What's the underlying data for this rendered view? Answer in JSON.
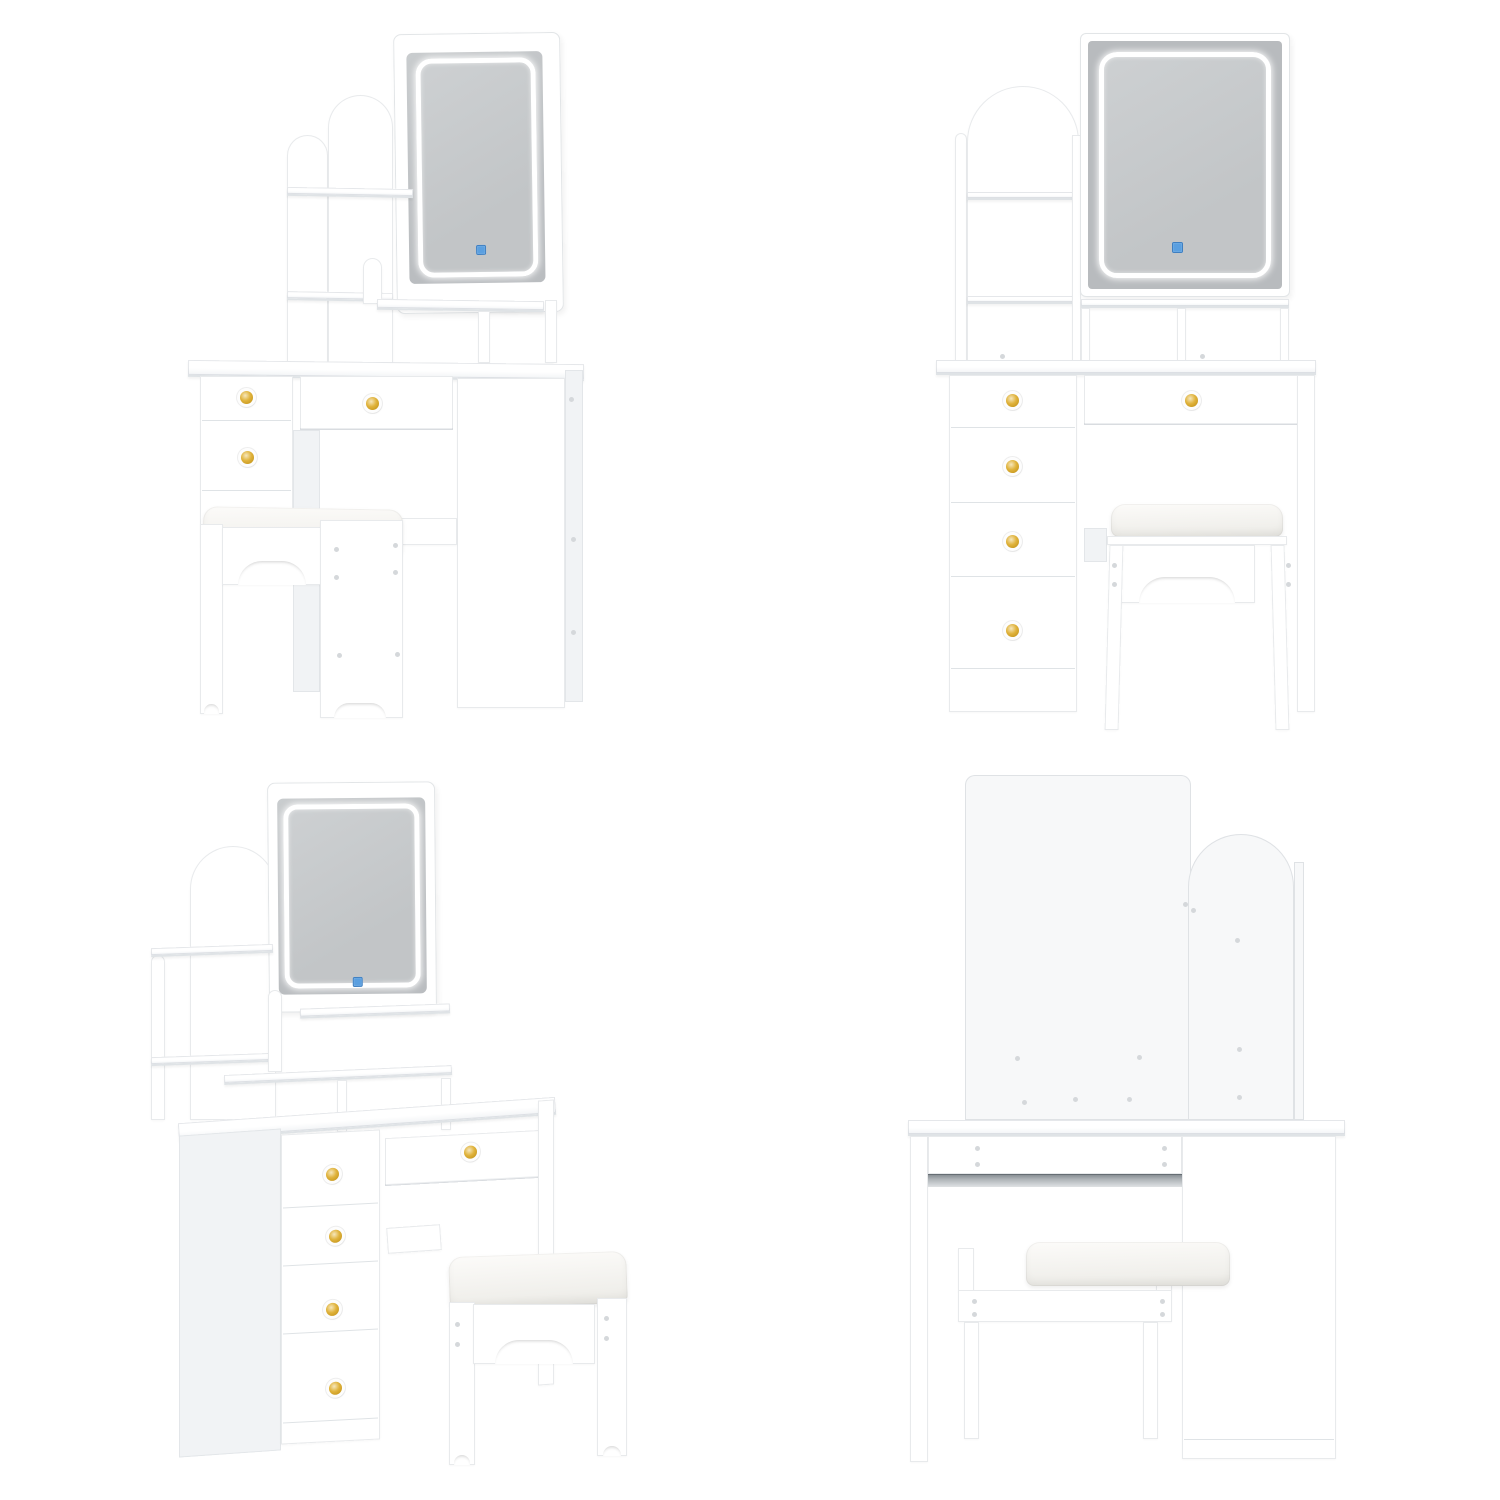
{
  "image": {
    "type": "product-photo-collage",
    "subject": "White vanity dressing table set with LED mirror, arched storage hutch, five drawers with gold knobs, and cushioned stool",
    "grid": "2x2",
    "views": [
      {
        "id": "top-left",
        "label": "Front three-quarter view from right"
      },
      {
        "id": "top-right",
        "label": "Front view"
      },
      {
        "id": "bottom-left",
        "label": "Front three-quarter view from left"
      },
      {
        "id": "bottom-right",
        "label": "Back view"
      }
    ],
    "details": {
      "drawer_count": 5,
      "knob_finish": "gold center with silver ring",
      "mirror": "rounded-rectangle LED halo mirror",
      "touch_sensor": "small blue square touch icon on mirror glass",
      "hutch": "arched open-shelf tower with cubbies beside mirror",
      "stool": "cushioned stool with arched cutout panels",
      "back_view_hardware": "cam screws and metal drawer slide rail visible"
    },
    "colors": {
      "page_bg": "#ffffff",
      "furniture_white": "#ffffff",
      "side_shade": "#f1f3f5",
      "back_panel": "#f7f8f9",
      "edge_line": "#dfe3e6",
      "mirror_glass": "#babdc0",
      "mirror_band": "#b8bbbe",
      "led_ring": "#ffffff",
      "touch_blue": "#5a9fe0",
      "knob_gold": "#e0b33c",
      "cushion": "#f0efeb",
      "metal_rail": "#80878d",
      "screw_dot": "#d5d8db"
    }
  }
}
